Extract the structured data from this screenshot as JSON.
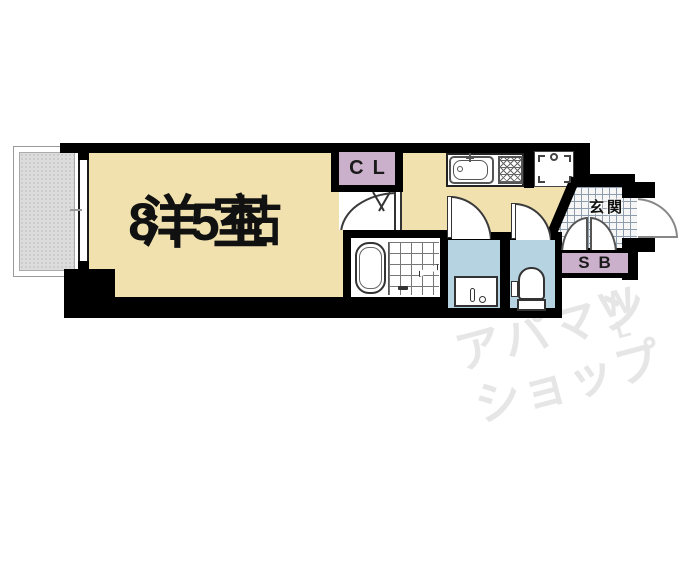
{
  "floor_plan": {
    "main_room": {
      "name": "洋室",
      "size": "8.5帖"
    },
    "closet": {
      "label": "CL"
    },
    "entrance": {
      "label": "玄関"
    },
    "shoe_box": {
      "label": "SB"
    }
  },
  "watermark": {
    "line1": "アパマン",
    "line2": "ショップ",
    "mark_top": "W",
    "mark_bottom": "L"
  },
  "colors": {
    "room": "#F0E1AE",
    "closet": "#CBB0CB",
    "wet_room": "#B6D3E2",
    "balcony": "#DCDCDC",
    "wall": "#000000",
    "watermark": "#E6E6E6",
    "tile_line": "#8E9DAD"
  }
}
